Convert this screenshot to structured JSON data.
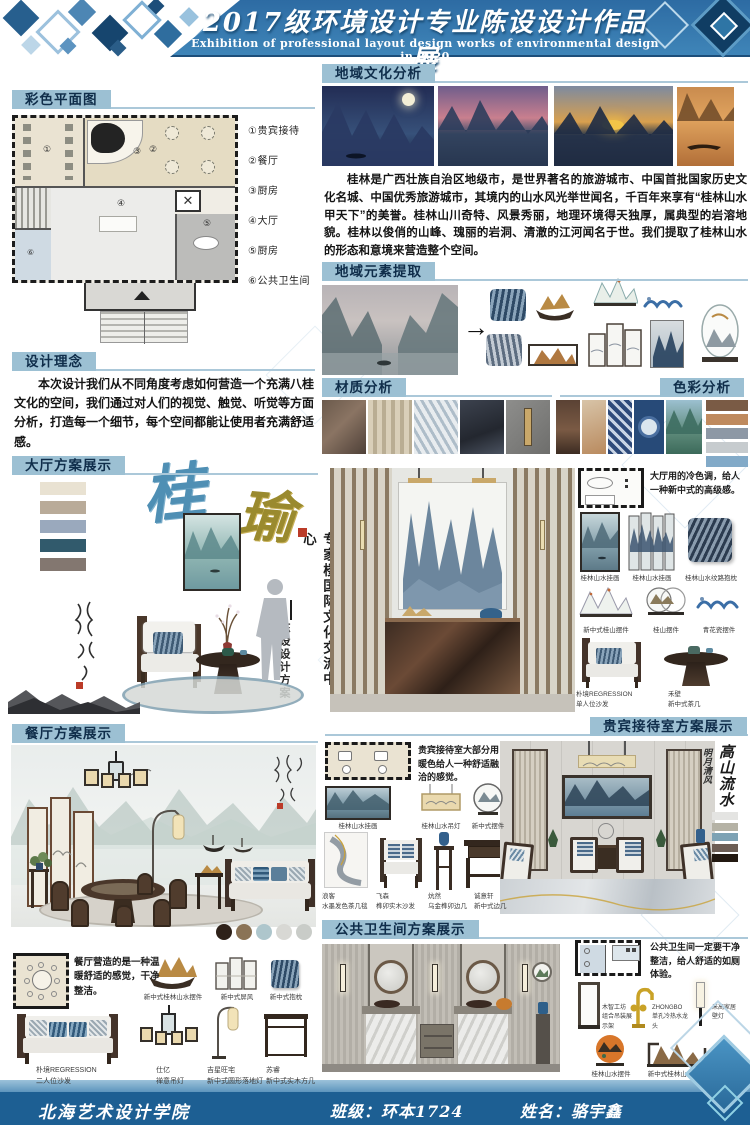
{
  "header": {
    "title": "2017级环境设计专业陈设设计作品展",
    "subtitle": "Exhibition of professional layout design works of environmental design in 2020"
  },
  "plan": {
    "title": "彩色平面图",
    "legend": [
      "①贵宾接待",
      "②餐厅",
      "③厨房",
      "④大厅",
      "⑤厨房",
      "⑥公共卫生间"
    ],
    "nums": [
      "①",
      "②",
      "③",
      "④",
      "⑤",
      "⑥"
    ]
  },
  "concept": {
    "title": "设计理念",
    "body": "本次设计我们从不同角度考虑如何营造一个充满八桂文化的空间，我们通过对人们的视觉、触觉、听觉等方面分析，打造每一个细节，每个空间都能让使用者充满舒适感。"
  },
  "culture": {
    "title": "地域文化分析",
    "body": "桂林是广西壮族自治区地级市，是世界著名的旅游城市、中国首批国家历史文化名城、中国优秀旅游城市，其境内的山水风光举世闻名，千百年来享有“桂林山水甲天下”的美誉。桂林山川奇特、风景秀丽，地理环境得天独厚，属典型的岩溶地貌。桂林以俊俏的山峰、瑰丽的岩洞、清澈的江河闻名于世。我们提取了桂林山水的形态和意境来营造整个空间。"
  },
  "elements": {
    "title": "地域元素提取"
  },
  "material": {
    "title": "材质分析"
  },
  "color_analysis": {
    "title": "色彩分析",
    "palette": [
      "#7a5b45",
      "#bf8a5e",
      "#8d98a5",
      "#c6cbce",
      "#82aac8"
    ]
  },
  "hall": {
    "title": "大厅方案展示",
    "calli_main": "桂",
    "calli_sub": "瑜",
    "vertical_title": "专家楼国际文化交流中心",
    "vertical_sub": "陈设设计方案",
    "note": "大厅用的冷色调，给人一种新中式的高级感。",
    "palette": [
      "#e9e2d2",
      "#b9ab99",
      "#9aa9bd",
      "#315a6c",
      "#837770"
    ],
    "items": [
      {
        "t": "桂林山水挂画"
      },
      {
        "t": "桂林山水挂画"
      },
      {
        "t": "桂林山水纹路抱枕"
      },
      {
        "t": "新中式桂山摆件"
      },
      {
        "t": "桂山摆件"
      },
      {
        "t": "青花瓷摆件"
      },
      {
        "t": "朴境REGRESSION",
        "s": "单人位沙发"
      },
      {
        "t": "禾壁",
        "s": "新中式茶几"
      }
    ]
  },
  "dining": {
    "title": "餐厅方案展示",
    "note": "餐厅营造的是一种温暖舒适的感觉，干净整洁。",
    "palette": [
      "#2e2119",
      "#8a7356",
      "#aec6cc",
      "#d8d8d4",
      "#c9ccc8"
    ],
    "items": [
      {
        "t": "新中式桂林山水摆件"
      },
      {
        "t": "新中式屏风"
      },
      {
        "t": "新中式抱枕"
      },
      {
        "t": "朴境REGRESSION",
        "s": "二人位沙发"
      },
      {
        "t": "仕亿",
        "s": "禅意吊灯"
      },
      {
        "t": "吉星旺宅",
        "s": "新中式圆形落地灯"
      },
      {
        "t": "苏睿",
        "s": "新中式实木方几"
      }
    ]
  },
  "vip": {
    "title": "贵宾接待室方案展示",
    "note": "贵宾接待室大部分用暖色给人一种舒适融洽的感觉。",
    "calligraphy": [
      "高山流水",
      "明月清风"
    ],
    "palette": [
      "#e4e4e2",
      "#b5b2a5",
      "#7da2b4",
      "#6d5e55",
      "#231911"
    ],
    "items": [
      {
        "t": "桂林山水挂画"
      },
      {
        "t": "桂林山水吊灯"
      },
      {
        "t": "新中式摆件"
      },
      {
        "t": "浪客",
        "s": "水墨发色茶几毯"
      },
      {
        "t": "飞森",
        "s": "榫卯实木沙发"
      },
      {
        "t": "炕然",
        "s": "乌金榫卯边几"
      },
      {
        "t": "诚意轩",
        "s": "新中式边几"
      }
    ]
  },
  "restroom": {
    "title": "公共卫生间方案展示",
    "note": "公共卫生间一定要干净整洁，给人舒适的如厕体验。",
    "items": [
      {
        "t": "木智工坊",
        "s": "组合吊装展示架"
      },
      {
        "t": "ZHONGBO",
        "s": "单孔冷热水龙头"
      },
      {
        "t": "米高家居",
        "s": "壁灯"
      },
      {
        "t": "桂林山水摆件"
      },
      {
        "t": "新中式桂林山水摆件"
      }
    ]
  },
  "footer": {
    "school": "北海艺术设计学院",
    "class": "班级：环本1724",
    "name": "姓名：骆宇鑫"
  }
}
